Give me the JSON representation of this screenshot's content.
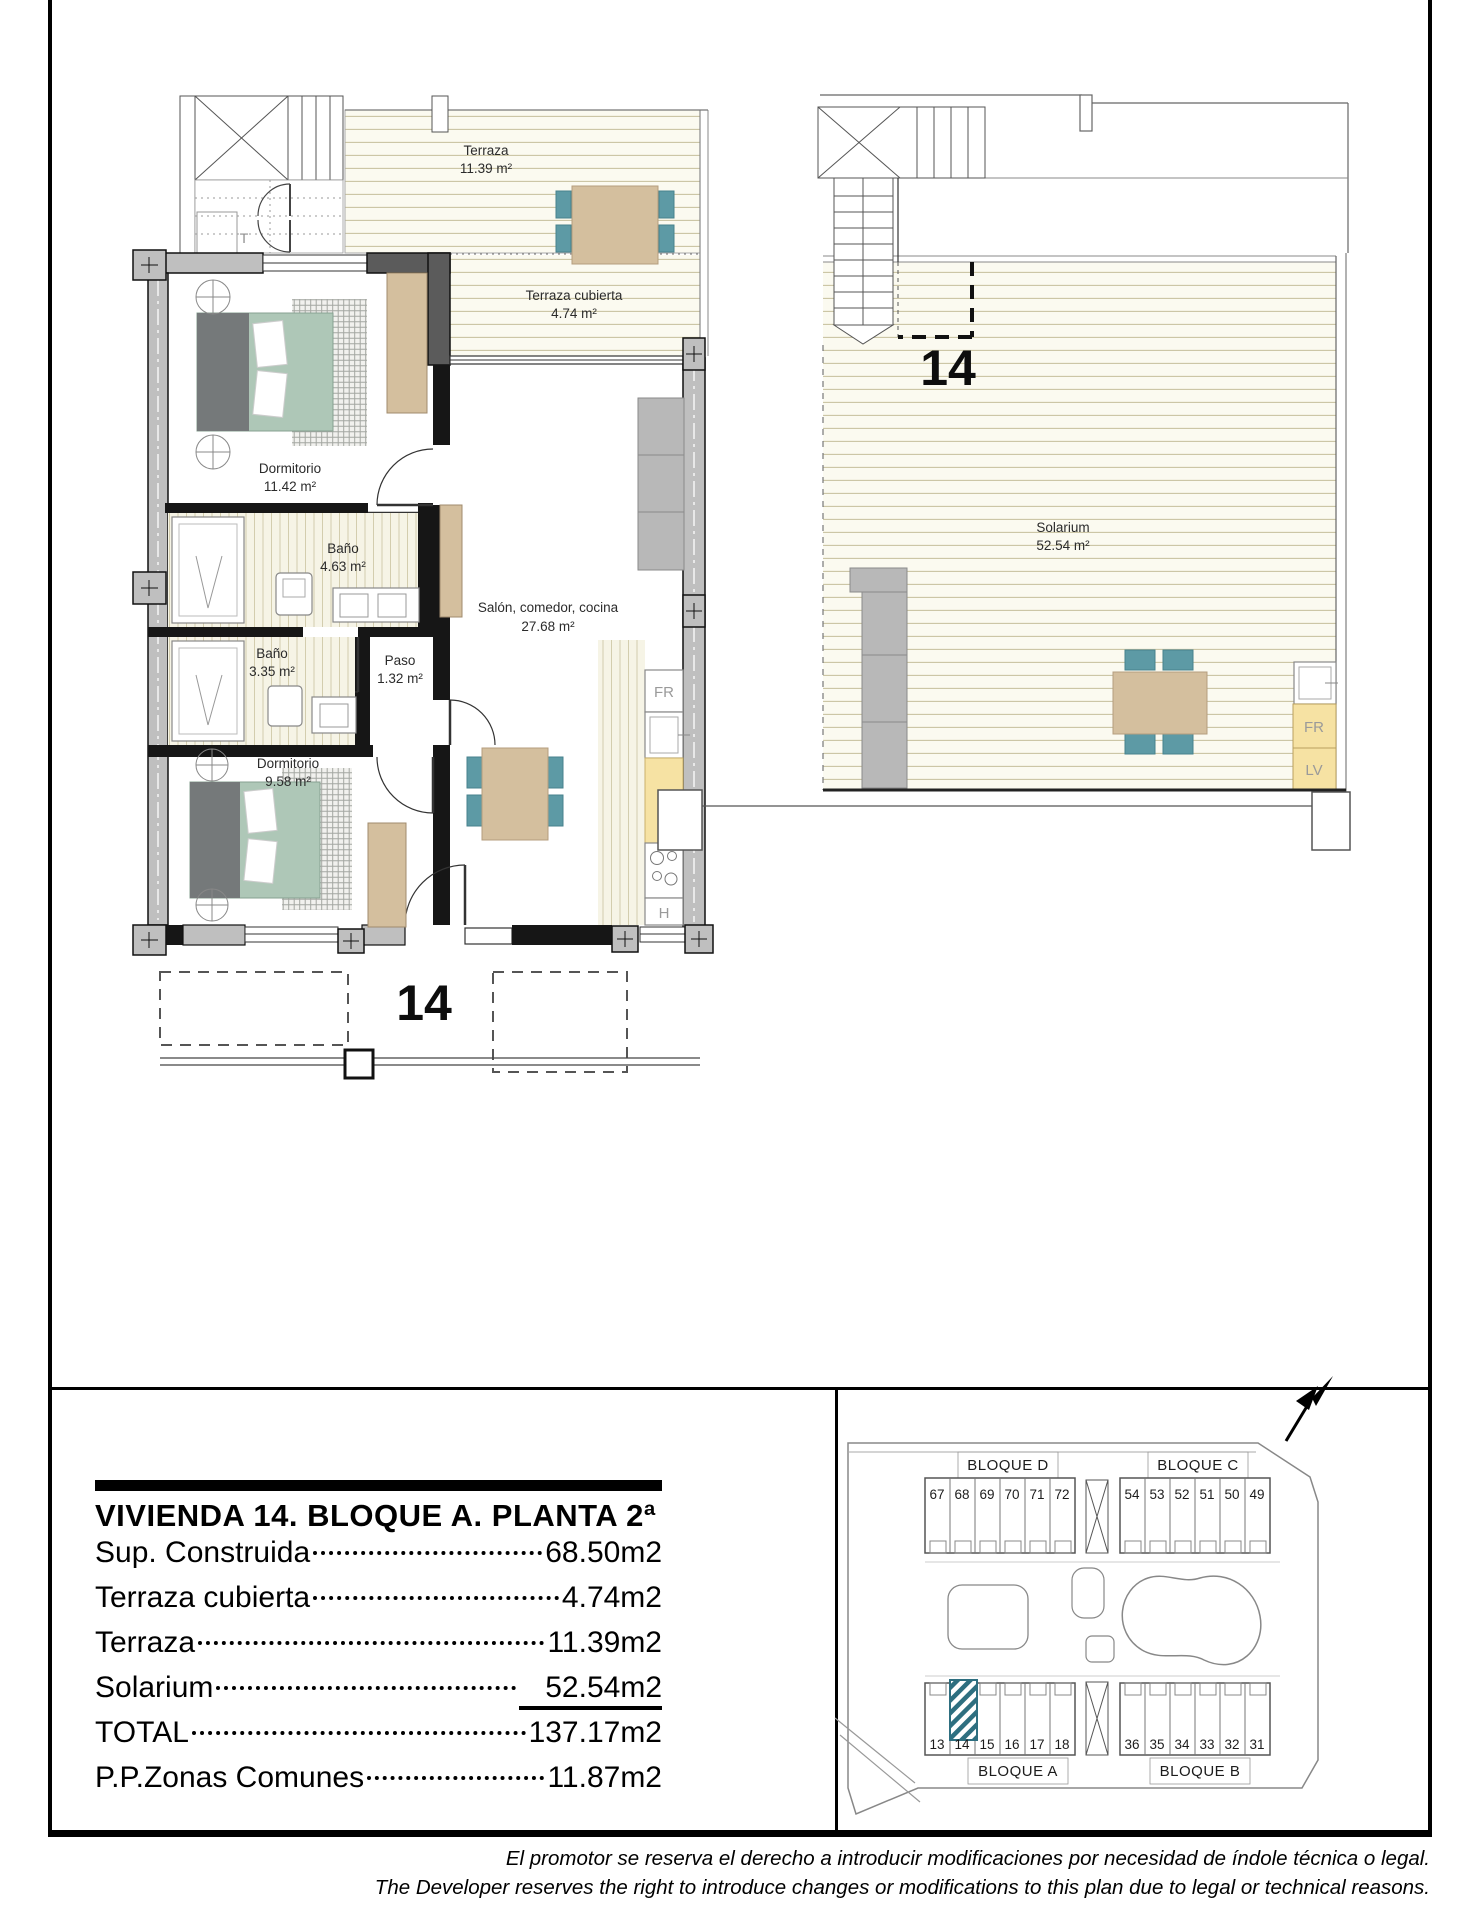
{
  "left_plan": {
    "unit_number": "14",
    "stair_label": "T",
    "rooms": {
      "terraza": {
        "name": "Terraza",
        "area": "11.39 m²"
      },
      "terraza_cubierta": {
        "name": "Terraza cubierta",
        "area": "4.74 m²"
      },
      "dormitorio1": {
        "name": "Dormitorio",
        "area": "11.42 m²"
      },
      "bano1": {
        "name": "Baño",
        "area": "4.63 m²"
      },
      "bano2": {
        "name": "Baño",
        "area": "3.35 m²"
      },
      "paso": {
        "name": "Paso",
        "area": "1.32 m²"
      },
      "dormitorio2": {
        "name": "Dormitorio",
        "area": "9.58 m²"
      },
      "salon": {
        "name": "Salón, comedor, cocina",
        "area": "27.68 m²"
      }
    },
    "appliances": {
      "fridge": "FR",
      "hob": "H"
    }
  },
  "right_plan": {
    "unit_number": "14",
    "room": {
      "name": "Solarium",
      "area": "52.54 m²"
    },
    "appliances": {
      "fridge": "FR",
      "washer": "LV"
    }
  },
  "info_table": {
    "title": "VIVIENDA 14. BLOQUE A. PLANTA 2ª",
    "rows": [
      {
        "label": "Sup. Construida",
        "value": "68.50m2"
      },
      {
        "label": "Terraza cubierta",
        "value": "4.74m2"
      },
      {
        "label": "Terraza",
        "value": "11.39m2"
      },
      {
        "label": "Solarium",
        "value": "52.54m2"
      },
      {
        "label": "TOTAL",
        "value": "137.17m2"
      },
      {
        "label": "P.P.Zonas Comunes",
        "value": "11.87m2"
      }
    ]
  },
  "site_plan": {
    "blocks": [
      {
        "name": "BLOQUE D",
        "units": [
          "67",
          "68",
          "69",
          "70",
          "71",
          "72"
        ]
      },
      {
        "name": "BLOQUE C",
        "units": [
          "54",
          "53",
          "52",
          "51",
          "50",
          "49"
        ]
      },
      {
        "name": "BLOQUE A",
        "units": [
          "13",
          "14",
          "15",
          "16",
          "17",
          "18"
        ]
      },
      {
        "name": "BLOQUE B",
        "units": [
          "36",
          "35",
          "34",
          "33",
          "32",
          "31"
        ]
      }
    ],
    "highlighted_unit": "14"
  },
  "disclaimer": {
    "es": "El promotor se reserva el derecho a introducir modificaciones por necesidad de índole técnica o legal.",
    "en": "The Developer reserves the right to introduce changes or modifications to this plan due to legal or technical reasons."
  },
  "colors": {
    "deck_line": "#c9c3a2",
    "wall_gray": "#c2c2c2",
    "bed_green": "#aec7b7",
    "furniture_tan": "#d4bf9e",
    "chair_teal": "#5d9aa5",
    "counter_yellow": "#f6e2a3",
    "sofa_gray": "#b8b8b8",
    "highlight_hatch": "#2e6f80"
  }
}
